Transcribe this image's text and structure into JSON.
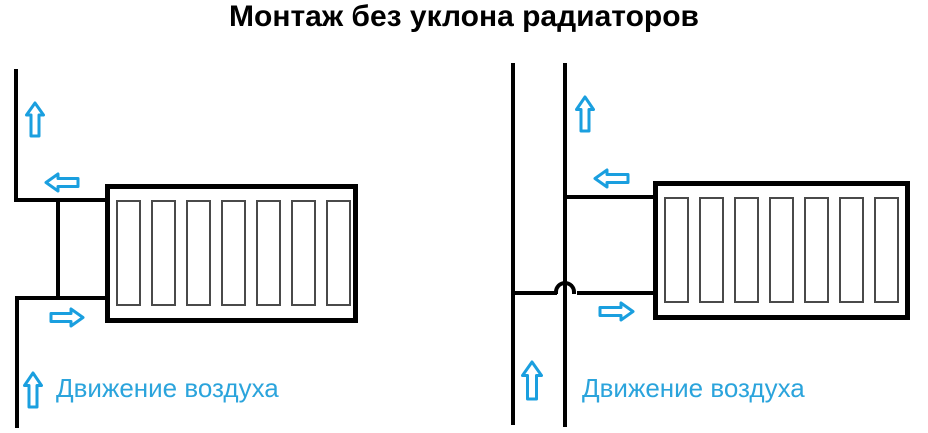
{
  "title": "Монтаж без уклона радиаторов",
  "colors": {
    "pipe": "#000000",
    "arrow": "#1a9fdf",
    "label": "#2ba4dc",
    "section_border": "#4a4a4a",
    "background": "#ffffff"
  },
  "diagrams": [
    {
      "side": "left",
      "air_label": "Движение воздуха",
      "sections": 7,
      "pipe_crossover": false,
      "arrows": [
        "air-up-arrow-top",
        "air-left-arrow",
        "air-right-arrow",
        "air-up-arrow-bottom"
      ]
    },
    {
      "side": "right",
      "air_label": "Движение воздуха",
      "sections": 7,
      "pipe_crossover": true,
      "arrows": [
        "air-up-arrow-top",
        "air-left-arrow",
        "air-right-arrow",
        "air-up-arrow-bottom"
      ]
    }
  ]
}
